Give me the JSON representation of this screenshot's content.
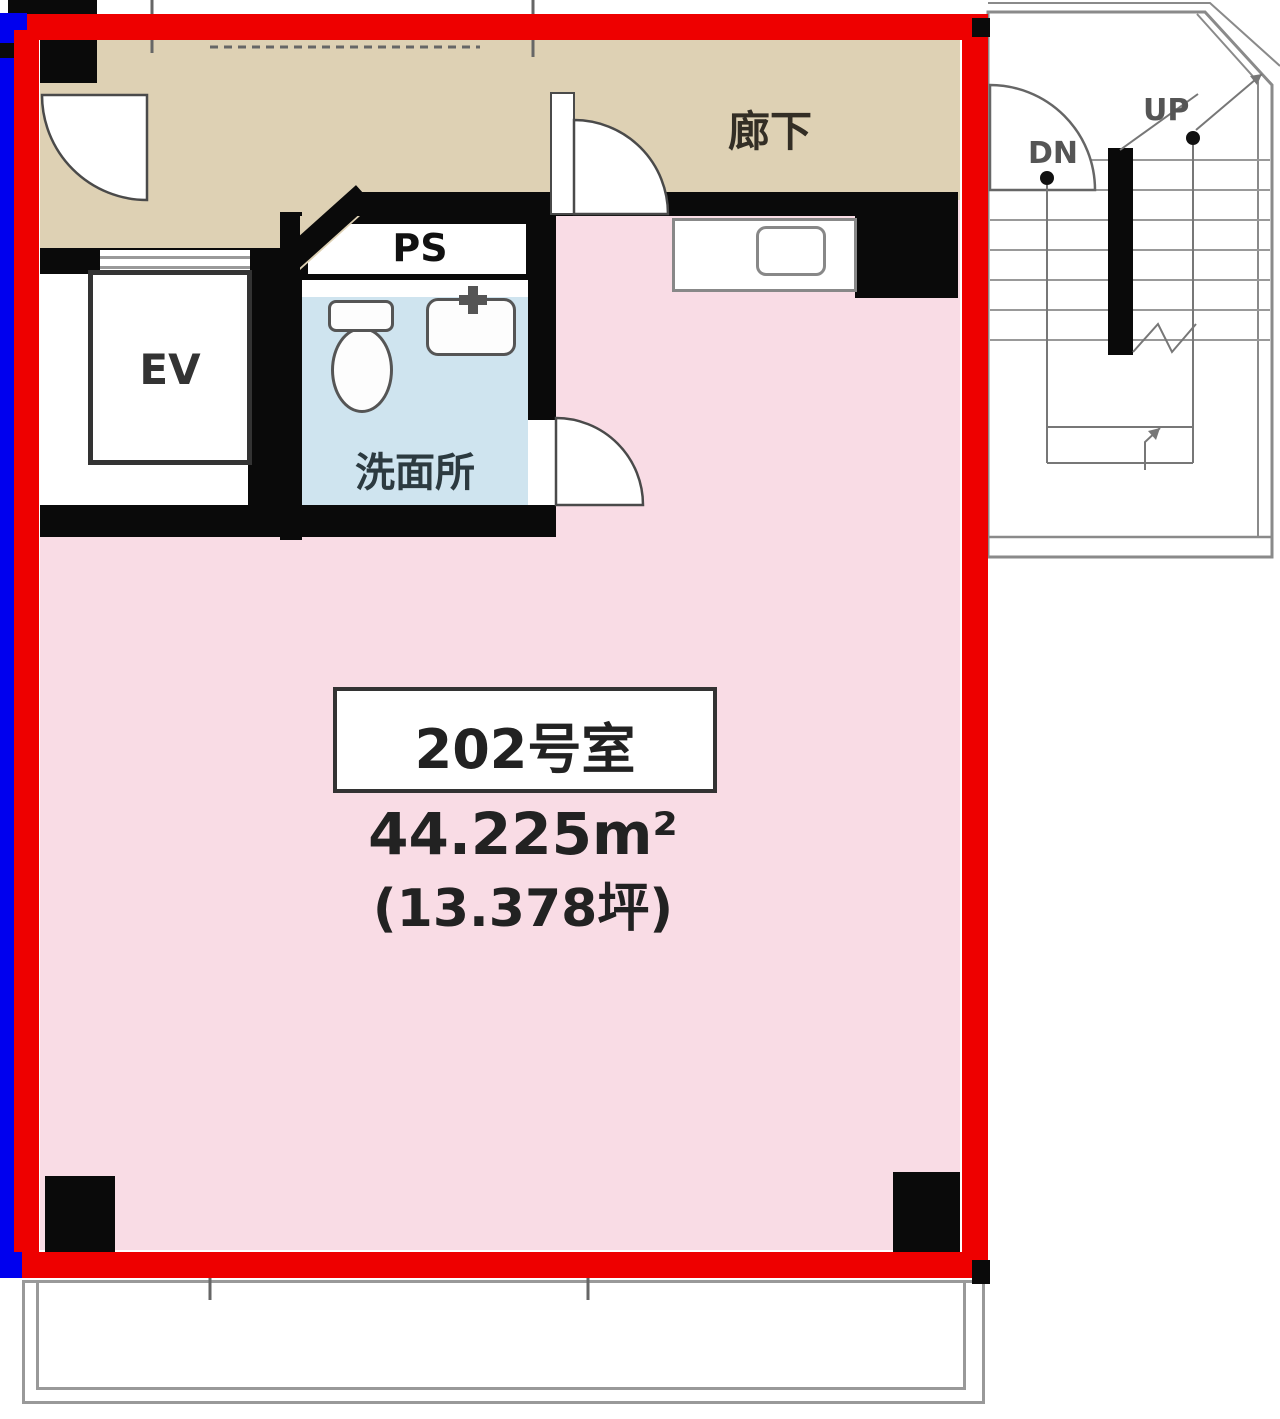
{
  "unit": {
    "room_label": "202号室",
    "area_m2": "44.225m²",
    "area_tsubo": "(13.378坪)"
  },
  "labels": {
    "corridor": "廊下",
    "washroom": "洗面所",
    "elevator": "EV",
    "pipe_space": "PS",
    "stairs_up": "UP",
    "stairs_down": "DN"
  },
  "colors": {
    "highlight_border": "#ee0000",
    "secondary_border": "#0000ee",
    "room_fill": "#f9dce5",
    "corridor_fill": "#ded1b4",
    "washroom_fill": "#cfe4ef",
    "wall": "#0a0a0a",
    "stair_line": "#8a8a8a"
  }
}
